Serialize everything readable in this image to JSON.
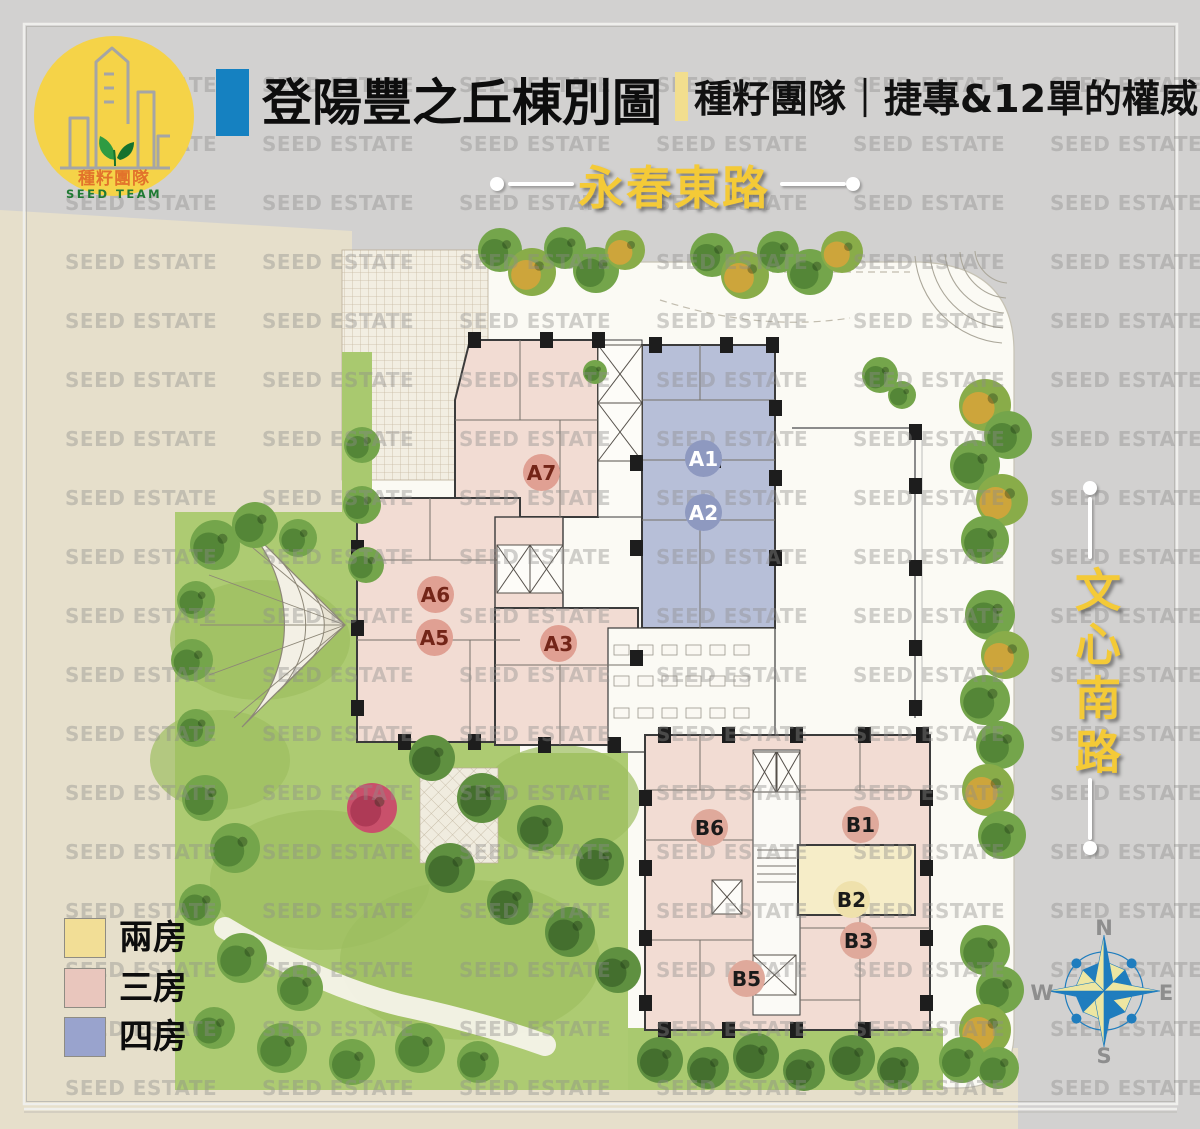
{
  "header": {
    "title": "登陽豐之丘棟別圖",
    "subtitle": "種籽團隊｜捷專&12單的權威",
    "accent_blue": "#1581C1",
    "accent_yellow": "#F2DE8E"
  },
  "logo": {
    "zh": "種籽團隊",
    "en": "SEED TEAM",
    "circle_color": "#F5D348"
  },
  "watermark": {
    "text": "SEED ESTATE"
  },
  "roads": {
    "top": "永春東路",
    "right": "文心南路",
    "label_color": "#F4CA37"
  },
  "legend": {
    "items": [
      {
        "label": "兩房",
        "color": "#F2DE96"
      },
      {
        "label": "三房",
        "color": "#E9C6BD"
      },
      {
        "label": "四房",
        "color": "#99A3CD"
      }
    ]
  },
  "compass": {
    "n": "N",
    "e": "E",
    "s": "S",
    "w": "W"
  },
  "map": {
    "palette": {
      "two_room": "#F6EDC8",
      "three_room": "#F2DCD3",
      "four_room": "#B7BFD8",
      "garden": "#ADCB72",
      "site": "#FBFAF4"
    },
    "units": [
      {
        "id": "A1",
        "x": 703,
        "y": 458,
        "bg": "#8E99C0",
        "fg": "#FFFFFF"
      },
      {
        "id": "A2",
        "x": 703,
        "y": 512,
        "bg": "#8E99C0",
        "fg": "#FFFFFF"
      },
      {
        "id": "A7",
        "x": 541,
        "y": 472,
        "bg": "#E0A093",
        "fg": "#732518"
      },
      {
        "id": "A6",
        "x": 435,
        "y": 594,
        "bg": "#E0A093",
        "fg": "#732518"
      },
      {
        "id": "A5",
        "x": 434,
        "y": 637,
        "bg": "#E0A093",
        "fg": "#732518"
      },
      {
        "id": "A3",
        "x": 558,
        "y": 643,
        "bg": "#E0A093",
        "fg": "#732518"
      },
      {
        "id": "B6",
        "x": 709,
        "y": 827,
        "bg": "#DFA99B",
        "fg": "#1A1A1A"
      },
      {
        "id": "B1",
        "x": 860,
        "y": 824,
        "bg": "#DFA99B",
        "fg": "#1A1A1A"
      },
      {
        "id": "B2",
        "x": 851,
        "y": 899,
        "bg": "#EFE1AC",
        "fg": "#1A1A1A"
      },
      {
        "id": "B3",
        "x": 858,
        "y": 940,
        "bg": "#DFA99B",
        "fg": "#1A1A1A"
      },
      {
        "id": "B5",
        "x": 746,
        "y": 978,
        "bg": "#DFA99B",
        "fg": "#1A1A1A"
      }
    ]
  }
}
